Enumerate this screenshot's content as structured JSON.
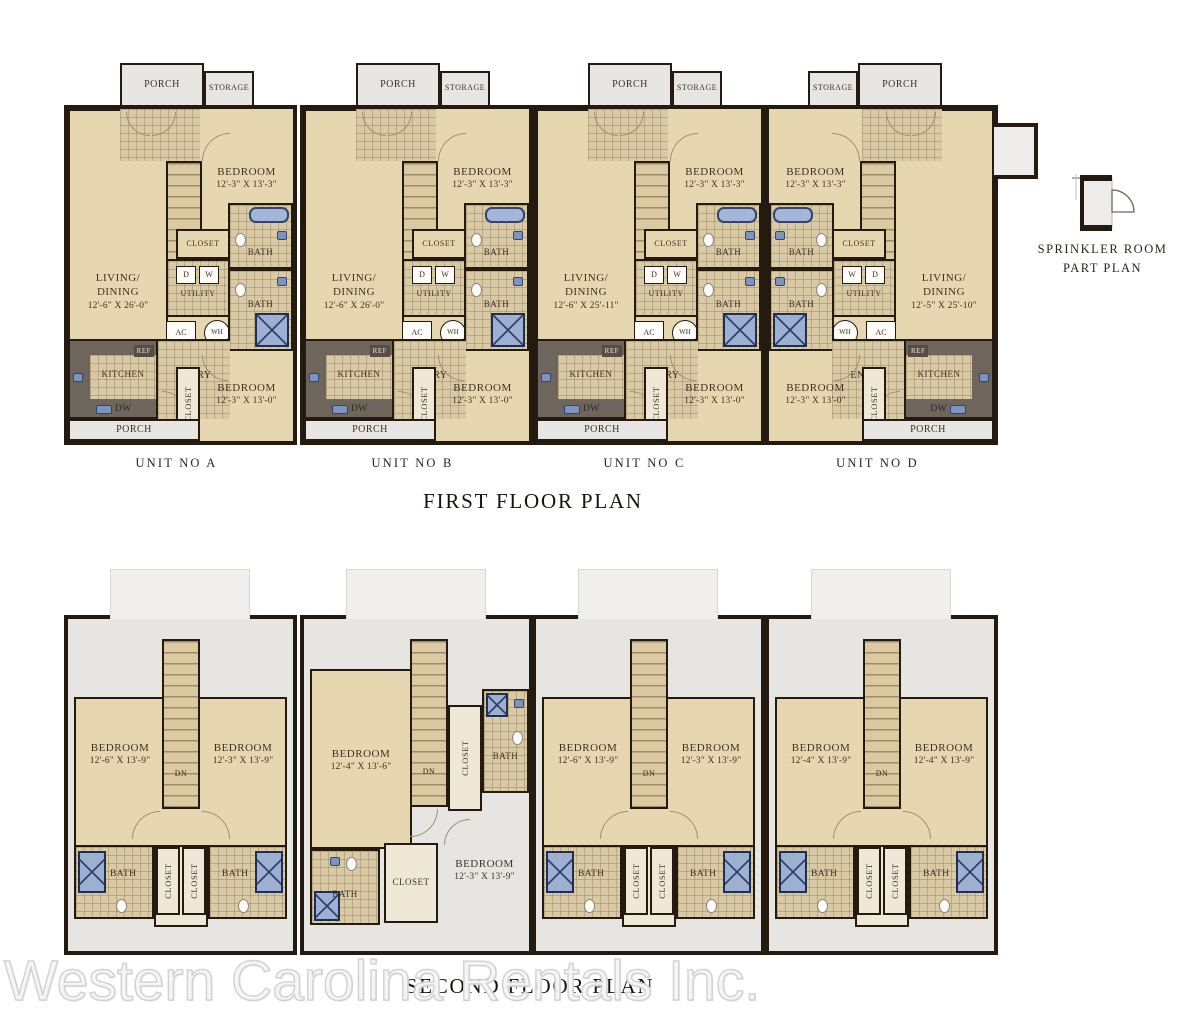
{
  "titles": {
    "first": "FIRST FLOOR PLAN",
    "second": "SECOND FLOOR PLAN"
  },
  "watermark": "Western Carolina Rentals Inc.",
  "sprinkler": {
    "line1": "SPRINKLER ROOM",
    "line2": "PART PLAN"
  },
  "colors": {
    "wall": "#241a10",
    "floor": "#e7d7b0",
    "tile": "#d9caa5",
    "porch": "#e8e6e2",
    "fixture_blue": "#9db0d2",
    "counter": "#6e665d"
  },
  "first": [
    {
      "label": "UNIT NO A",
      "porch": "PORCH",
      "storage": "STORAGE",
      "living": "LIVING/",
      "dining": "DINING",
      "living_dims": "12'-6\" X 26'-0\"",
      "bed1": "BEDROOM",
      "bed1_dims": "12'-3\" X 13'-3\"",
      "up": "UP",
      "closet1": "CLOSET",
      "bath1": "BATH",
      "d": "D",
      "w": "W",
      "utility": "UTILITY",
      "ac": "AC",
      "wh": "WH",
      "bath2": "BATH",
      "ref": "REF",
      "kitchen": "KITCHEN",
      "entry": "ENTRY",
      "dw": "DW",
      "bed2": "BEDROOM",
      "bed2_dims": "12'-3\" X 13'-0\"",
      "closet2": "CLOSET",
      "porch2": "PORCH"
    },
    {
      "label": "UNIT NO B",
      "porch": "PORCH",
      "storage": "STORAGE",
      "living": "LIVING/",
      "dining": "DINING",
      "living_dims": "12'-6\" X 26'-0\"",
      "bed1": "BEDROOM",
      "bed1_dims": "12'-3\" X 13'-3\"",
      "up": "UP",
      "closet1": "CLOSET",
      "bath1": "BATH",
      "d": "D",
      "w": "W",
      "utility": "UTILITY",
      "ac": "AC",
      "wh": "WH",
      "bath2": "BATH",
      "ref": "REF",
      "kitchen": "KITCHEN",
      "entry": "ENTRY",
      "dw": "DW",
      "bed2": "BEDROOM",
      "bed2_dims": "12'-3\" X 13'-0\"",
      "closet2": "CLOSET",
      "porch2": "PORCH"
    },
    {
      "label": "UNIT NO C",
      "porch": "PORCH",
      "storage": "STORAGE",
      "living": "LIVING/",
      "dining": "DINING",
      "living_dims": "12'-6\" X 25'-11\"",
      "bed1": "BEDROOM",
      "bed1_dims": "12'-3\" X 13'-3\"",
      "up": "UP",
      "closet1": "CLOSET",
      "bath1": "BATH",
      "d": "D",
      "w": "W",
      "utility": "UTILITY",
      "ac": "AC",
      "wh": "WH",
      "bath2": "BATH",
      "ref": "REF",
      "kitchen": "KITCHEN",
      "entry": "ENTRY",
      "dw": "DW",
      "bed2": "BEDROOM",
      "bed2_dims": "12'-3\" X 13'-0\"",
      "closet2": "CLOSET",
      "porch2": "PORCH"
    },
    {
      "label": "UNIT NO D",
      "porch": "PORCH",
      "storage": "STORAGE",
      "living": "LIVING/",
      "dining": "DINING",
      "living_dims": "12'-5\" X 25'-10\"",
      "bed1": "BEDROOM",
      "bed1_dims": "12'-3\" X 13'-3\"",
      "up": "UP",
      "closet1": "CLOSET",
      "bath1": "BATH",
      "d": "D",
      "w": "W",
      "utility": "UTILITY",
      "ac": "AC",
      "wh": "WH",
      "bath2": "BATH",
      "ref": "REF",
      "kitchen": "KITCHEN",
      "entry": "ENTRY",
      "dw": "DW",
      "bed2": "BEDROOM",
      "bed2_dims": "12'-3\" X 13'-0\"",
      "closet2": "CLOSET",
      "porch2": "PORCH"
    }
  ],
  "second": [
    {
      "bedL": "BEDROOM",
      "bedL_dims": "12'-6\" X 13'-9\"",
      "bedR": "BEDROOM",
      "bedR_dims": "12'-3\" X 13'-9\"",
      "dn": "DN",
      "closetL": "CLOSET",
      "closetR": "CLOSET",
      "bathL": "BATH",
      "bathR": "BATH"
    },
    {
      "bed1": "BEDROOM",
      "bed1_dims": "12'-4\" X 13'-6\"",
      "dn": "DN",
      "closet_top": "CLOSET",
      "bath_top": "BATH",
      "bath_left": "BATH",
      "closet_mid": "CLOSET",
      "bed2": "BEDROOM",
      "bed2_dims": "12'-3\" X 13'-9\""
    },
    {
      "bedL": "BEDROOM",
      "bedL_dims": "12'-6\" X 13'-9\"",
      "bedR": "BEDROOM",
      "bedR_dims": "12'-3\" X 13'-9\"",
      "dn": "DN",
      "closetL": "CLOSET",
      "closetR": "CLOSET",
      "bathL": "BATH",
      "bathR": "BATH"
    },
    {
      "bedL": "BEDROOM",
      "bedL_dims": "12'-4\" X 13'-9\"",
      "bedR": "BEDROOM",
      "bedR_dims": "12'-4\" X 13'-9\"",
      "dn": "DN",
      "closetL": "CLOSET",
      "closetR": "CLOSET",
      "bathL": "BATH",
      "bathR": "BATH"
    }
  ]
}
